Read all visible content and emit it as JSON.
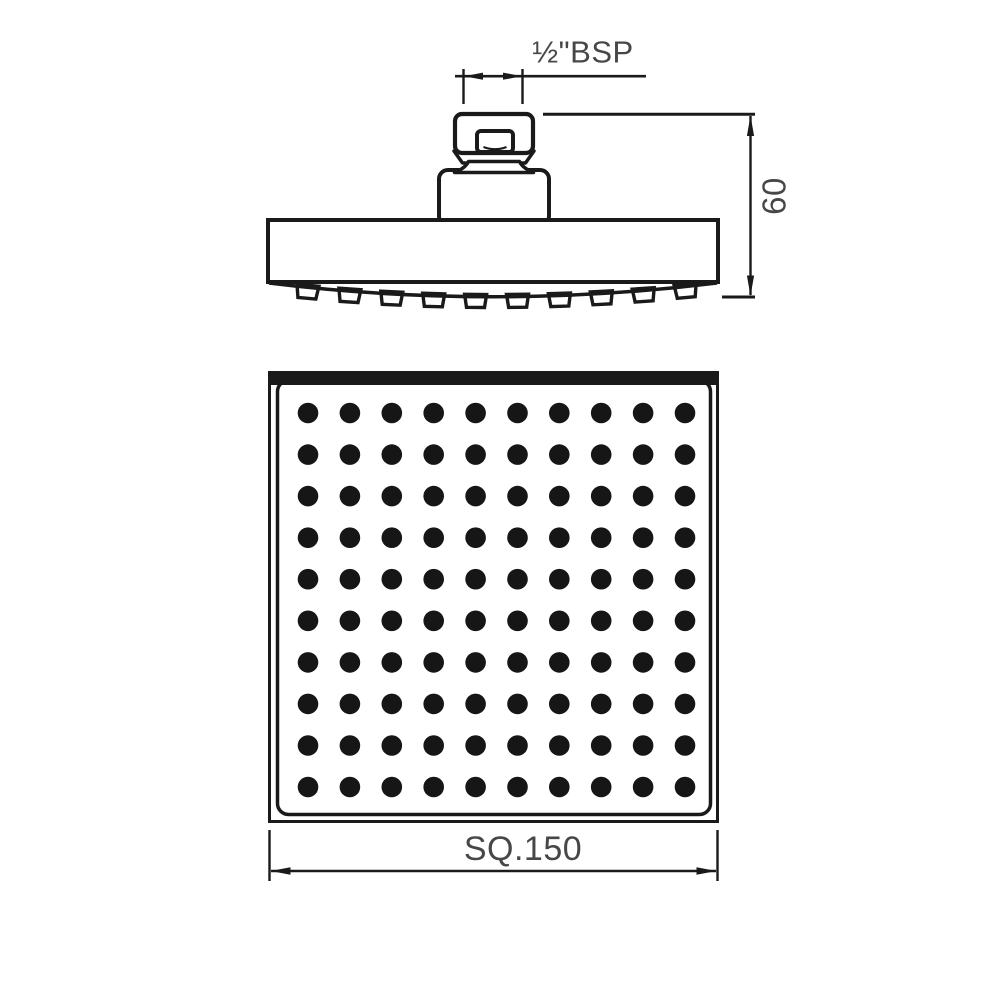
{
  "drawing": {
    "kind": "technical-drawing",
    "subject": "square overhead rain shower head, side elevation and face view"
  },
  "labels": {
    "thread_size": "½\"BSP",
    "height": "60",
    "face_size": "SQ.150"
  },
  "side_view": {
    "nozzle_count": 10
  },
  "bottom_view": {
    "nozzle_grid": {
      "rows": 10,
      "cols": 10
    }
  },
  "colors": {
    "line": "#1a1a1a",
    "text": "#474747",
    "dot": "#161616",
    "background": "#ffffff"
  }
}
